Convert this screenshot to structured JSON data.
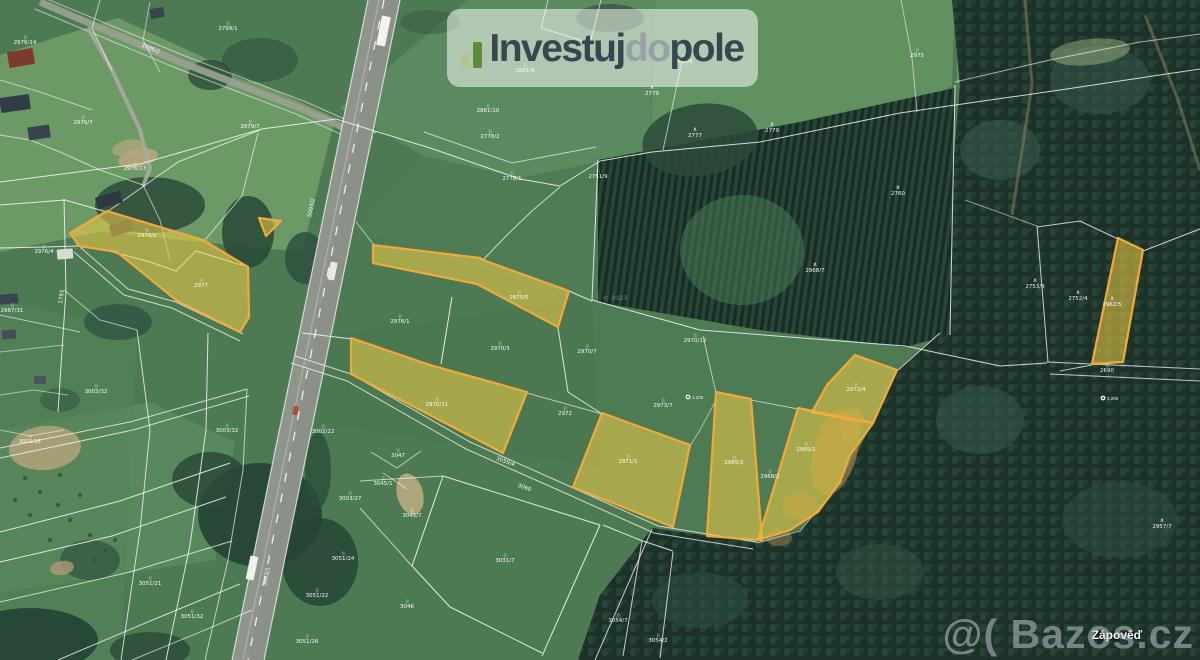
{
  "logo": {
    "invest": "Investuj",
    "do_part": "do",
    "pole": "pole"
  },
  "watermark": {
    "text": "@( Bazos.cz"
  },
  "place_label": {
    "text": "Zápověď"
  },
  "map": {
    "colors": {
      "base": "#4e7a53",
      "forest_base": "#1d332a",
      "plantation_base": "#223d31",
      "highlight_fill": "rgba(240,205,70,0.55)",
      "highlight_stroke": "#f2a93b",
      "road": "#8f948d",
      "boundary_line": "#ffffff"
    },
    "fields": [
      {
        "p": "0,55 118,18 335,118 302,252 100,232 0,252",
        "f": "#6f9b68",
        "o": 0.95
      },
      {
        "p": "340,108 468,0 655,0 650,152 520,178 424,156",
        "f": "#5c8b60",
        "o": 0.95
      },
      {
        "p": "655,0 955,0 952,86 900,112 760,141 651,151",
        "f": "#649263",
        "o": 0.9
      },
      {
        "p": "957,0 1200,0 1200,34 1050,60 957,84",
        "f": "#6f9a67",
        "o": 0.85
      },
      {
        "p": "424,157 520,179 600,162 592,300 356,231",
        "f": "#507d55",
        "o": 0.8
      },
      {
        "p": "302,338 592,300 703,332 790,410 600,468 302,420",
        "f": "#4a7650",
        "o": 0.55
      },
      {
        "p": "592,300 905,346 873,423 840,482 757,543 652,528 600,470",
        "f": "#4f7c54",
        "o": 0.7
      },
      {
        "p": "0,430 150,402 235,442 215,560 0,592",
        "f": "#5f8e62",
        "o": 0.7
      },
      {
        "p": "0,300 137,330 121,660 0,660",
        "f": "#568358",
        "o": 0.5
      },
      {
        "p": "250,445 443,476 360,508 412,566 450,607 542,653 560,660 230,660",
        "f": "#4c7951",
        "o": 0.6
      }
    ],
    "forest": {
      "main": {
        "p": "952,0 1200,0 1200,660 578,660 600,595 652,528 757,543 800,530 840,482 873,423 897,370 940,332 950,200 960,86"
      },
      "plantation": {
        "p": "598,160 800,122 955,88 950,335 905,347 760,330 598,302"
      },
      "blobs": [
        [
          742,
          250,
          62,
          55,
          "#4c7f58",
          0.5,
          0
        ],
        [
          700,
          140,
          58,
          36,
          "#2a4a38",
          0.85,
          -8
        ],
        [
          610,
          18,
          34,
          14,
          "#31523c",
          0.7,
          0
        ],
        [
          150,
          205,
          55,
          28,
          "#2b4b39",
          0.85,
          0
        ],
        [
          248,
          232,
          26,
          36,
          "#2b4b39",
          0.9,
          0
        ],
        [
          305,
          258,
          20,
          26,
          "#2e5040",
          0.85,
          0
        ],
        [
          210,
          75,
          22,
          15,
          "#2a4a38",
          0.8,
          0
        ],
        [
          260,
          60,
          38,
          22,
          "#2e5040",
          0.6,
          0
        ],
        [
          118,
          322,
          34,
          18,
          "#2e5040",
          0.75,
          0
        ],
        [
          260,
          515,
          62,
          52,
          "#244234",
          0.9,
          0
        ],
        [
          210,
          480,
          38,
          28,
          "#2a4a38",
          0.85,
          0
        ],
        [
          320,
          562,
          38,
          44,
          "#274536",
          0.85,
          0
        ],
        [
          318,
          470,
          13,
          38,
          "#2d4d3b",
          0.8,
          0
        ],
        [
          300,
          392,
          9,
          22,
          "#2d4d3b",
          0.7,
          0
        ],
        [
          30,
          640,
          68,
          32,
          "#244234",
          0.9,
          0
        ],
        [
          150,
          650,
          40,
          18,
          "#2a4a38",
          0.8,
          0
        ],
        [
          1000,
          150,
          40,
          30,
          "#3a5f50",
          0.5,
          0
        ],
        [
          1100,
          80,
          50,
          34,
          "#34594a",
          0.5,
          0
        ],
        [
          980,
          420,
          44,
          34,
          "#365c4d",
          0.5,
          0
        ],
        [
          1120,
          520,
          58,
          38,
          "#305447",
          0.45,
          0
        ],
        [
          700,
          600,
          48,
          28,
          "#2e5245",
          0.5,
          0
        ],
        [
          880,
          572,
          44,
          28,
          "#335848",
          0.45,
          0
        ],
        [
          430,
          22,
          30,
          12,
          "#35573f",
          0.5,
          0
        ],
        [
          372,
          60,
          14,
          10,
          "#30523e",
          0.6,
          0
        ],
        [
          90,
          560,
          30,
          20,
          "#2a4a38",
          0.6,
          0
        ],
        [
          60,
          400,
          20,
          12,
          "#2e5040",
          0.5,
          0
        ]
      ]
    },
    "dots": [
      [
        25,
        478
      ],
      [
        40,
        492
      ],
      [
        58,
        505
      ],
      [
        30,
        515
      ],
      [
        70,
        520
      ],
      [
        90,
        535
      ],
      [
        50,
        540
      ],
      [
        105,
        550
      ],
      [
        80,
        495
      ],
      [
        15,
        500
      ],
      [
        95,
        560
      ],
      [
        115,
        540
      ],
      [
        35,
        468
      ],
      [
        60,
        475
      ]
    ],
    "soil": [
      [
        138,
        158,
        20,
        9,
        "#b7a67c",
        0.9,
        -12
      ],
      [
        45,
        448,
        36,
        22,
        "#b3a37a",
        0.85,
        -5
      ],
      [
        410,
        494,
        13,
        21,
        "#b9aa80",
        0.9,
        -15
      ],
      [
        62,
        568,
        12,
        7,
        "#ab9a72",
        0.8,
        -10
      ],
      [
        835,
        452,
        22,
        44,
        "#8c7b4a",
        0.8,
        15
      ],
      [
        800,
        506,
        17,
        13,
        "#8c7b4a",
        0.65,
        0
      ],
      [
        779,
        538,
        13,
        8,
        "#8c7b4a",
        0.6,
        0
      ],
      [
        852,
        424,
        12,
        17,
        "#96854f",
        0.55,
        10
      ],
      [
        1090,
        52,
        40,
        13,
        "#9ab27f",
        0.5,
        -6
      ],
      [
        128,
        148,
        16,
        8,
        "#b7a67c",
        0.7,
        -12
      ]
    ],
    "road": {
      "band": "368,0 400,0 264,660 232,660",
      "band_right": "384,0 400,0 264,660 248,660",
      "center": "384,0 248,660",
      "median": "379,0 243,660",
      "edges": [
        "368,0 232,660",
        "400,0 264,660"
      ],
      "local": "40,2 180,62 300,108 372,140",
      "local_edges": [
        "42,-3 185,56 306,102 376,133",
        "35,9 176,68 296,114 369,147"
      ],
      "driveway": "88,28 112,70 140,130 150,168 143,186",
      "dirt": [
        "1025,0 1032,85 1012,215",
        "1145,15 1178,100 1200,170"
      ]
    },
    "tracks": [
      "80,247 128,289 176,302 243,334",
      "74,252 124,295 172,308 240,341",
      "295,356 351,374 470,442 560,482 658,526 757,542",
      "291,363 347,381 466,449 556,489 654,533 753,549",
      "0,448 130,422 247,389",
      "0,458 133,430 249,396",
      "1047,362 1200,369",
      "1050,374 1200,381"
    ],
    "lines": [
      {
        "p": "0,182 140,164 262,129 336,119"
      },
      {
        "p": "336,119 430,148 520,179 560,186 600,161"
      },
      {
        "p": "600,161 652,152 760,142 900,113 1060,90 1200,69"
      },
      {
        "p": "598,160 592,300"
      },
      {
        "p": "592,300 700,330 905,346"
      },
      {
        "p": "955,85 950,335"
      },
      {
        "p": "955,82 1050,60 1140,42 1200,34",
        "o": 0.6
      },
      {
        "p": "424,132 512,163 596,147",
        "o": 0.65
      },
      {
        "p": "548,0 541,28 590,43 601,0",
        "o": 0.65
      },
      {
        "p": "683,57 663,150",
        "o": 0.6
      },
      {
        "p": "0,205 65,200 107,212"
      },
      {
        "p": "64,199 66,290 58,412",
        "o": 0.8
      },
      {
        "p": "107,212 178,162 260,130",
        "o": 0.7
      },
      {
        "p": "205,240 242,196 258,133",
        "o": 0.6
      },
      {
        "p": "0,248 45,247 79,246",
        "o": 0.8
      },
      {
        "p": "0,315 80,332",
        "o": 0.6
      },
      {
        "p": "302,333 352,339",
        "o": 0.8
      },
      {
        "p": "356,222 374,245",
        "o": 0.6
      },
      {
        "p": "452,297 441,364",
        "o": 0.85
      },
      {
        "p": "483,260 506,236 532,211 560,187",
        "o": 0.7
      },
      {
        "p": "569,291 592,301",
        "o": 0.8
      },
      {
        "p": "558,328 568,392 602,414",
        "o": 0.8
      },
      {
        "p": "527,393 602,414",
        "o": 0.6
      },
      {
        "p": "703,336 716,393",
        "o": 0.6
      },
      {
        "p": "751,400 798,409",
        "o": 0.6
      },
      {
        "p": "897,371 940,333",
        "o": 0.8
      },
      {
        "p": "905,346 1000,366 1047,363",
        "o": 0.8
      },
      {
        "p": "1037,226 1048,362",
        "o": 0.75
      },
      {
        "p": "1118,239 1080,221 1037,227",
        "o": 0.75
      },
      {
        "p": "1143,251 1200,229",
        "o": 0.8
      },
      {
        "p": "1092,365 1060,371",
        "o": 0.7
      },
      {
        "p": "965,200 1037,226",
        "o": 0.5
      },
      {
        "p": "443,476 600,525",
        "o": 0.85
      },
      {
        "p": "443,476 412,566",
        "o": 0.85
      },
      {
        "p": "412,566 450,607",
        "o": 0.85
      },
      {
        "p": "450,607 542,653",
        "o": 0.85
      },
      {
        "p": "600,525 542,656",
        "o": 0.85
      },
      {
        "p": "603,525 640,540 673,551",
        "o": 0.8
      },
      {
        "p": "642,541 623,656",
        "o": 0.75
      },
      {
        "p": "673,552 660,658",
        "o": 0.75
      },
      {
        "p": "360,481 443,476",
        "o": 0.65
      },
      {
        "p": "360,508 412,566",
        "o": 0.65
      },
      {
        "p": "371,452 397,468 421,451",
        "o": 0.6
      },
      {
        "p": "383,473 407,489",
        "o": 0.6
      },
      {
        "p": "0,532 120,501 230,463",
        "o": 0.8
      },
      {
        "p": "0,562 112,536 226,497",
        "o": 0.8
      },
      {
        "p": "0,602 130,572 232,541",
        "o": 0.7
      },
      {
        "p": "58,660 150,621 240,584",
        "o": 0.75
      },
      {
        "p": "132,660 205,630 252,610",
        "o": 0.6
      },
      {
        "p": "137,330 150,430 140,530 121,660",
        "o": 0.75
      },
      {
        "p": "208,333 206,430 190,545 166,660",
        "o": 0.8
      },
      {
        "p": "247,389 243,470 228,560 205,660",
        "o": 0.65
      },
      {
        "p": "64,290 100,320 137,330",
        "o": 0.55
      },
      {
        "p": "0,352 64,345",
        "o": 0.5
      },
      {
        "p": "595,660 652,529",
        "o": 0.75
      },
      {
        "p": "757,543 800,531 840,483",
        "o": 0.6
      },
      {
        "p": "901,0 912,58 917,112",
        "o": 0.55
      },
      {
        "p": "105,250 150,262 176,271 196,251 248,267",
        "o": 0.85
      },
      {
        "p": "0,430 30,436 64,430",
        "o": 0.5
      },
      {
        "p": "100,0 92,28 112,70",
        "o": 0.6
      },
      {
        "p": "150,2 143,40 160,72",
        "o": 0.5
      },
      {
        "p": "0,80 40,92 92,110",
        "o": 0.55
      },
      {
        "p": "0,135 30,140 60,152 100,170 143,185",
        "o": 0.6
      },
      {
        "p": "143,185 160,220 170,260",
        "o": 0.55
      },
      {
        "p": "0,395 34,390 68,395",
        "o": 0.5
      },
      {
        "p": "690,446 700,430 716,400",
        "o": 0.5
      }
    ],
    "houses": [
      [
        8,
        50,
        26,
        16,
        -10,
        "#7d3a2e"
      ],
      [
        0,
        96,
        30,
        15,
        -8,
        "#323c47"
      ],
      [
        28,
        126,
        22,
        13,
        -8,
        "#39434e"
      ],
      [
        96,
        194,
        26,
        12,
        -16,
        "#2e3841"
      ],
      [
        110,
        222,
        22,
        12,
        -16,
        "#333d48"
      ],
      [
        57,
        249,
        16,
        10,
        -5,
        "#d8dad4"
      ],
      [
        0,
        294,
        18,
        10,
        -5,
        "#3a444f"
      ],
      [
        2,
        330,
        14,
        9,
        -5,
        "#434d58"
      ],
      [
        34,
        376,
        12,
        8,
        0,
        "#4a545e"
      ],
      [
        150,
        8,
        14,
        10,
        -10,
        "#3a444e"
      ]
    ],
    "vehicles": [
      [
        379,
        16,
        9,
        30,
        "#f2f2ef"
      ],
      [
        329,
        262,
        7,
        18,
        "#e9e9e4"
      ],
      [
        293,
        406,
        5,
        9,
        "#b84a3a"
      ],
      [
        248,
        556,
        8,
        24,
        "#f0f0ec"
      ]
    ],
    "yellow_parcels": [
      {
        "p": "70,233 107,211 203,240 248,267 249,317 240,332 176,300 117,252 105,250 79,246",
        "t": "2977",
        "lx": 201,
        "ly": 287,
        "s": ""
      },
      {
        "p": "259,218 281,221 266,236",
        "t": "",
        "lx": 0,
        "ly": 0,
        "s": ""
      },
      {
        "p": "373,245 480,258 483,260 569,291 558,327 477,284 373,263",
        "t": "2970/5",
        "lx": 519,
        "ly": 299,
        "s": ""
      },
      {
        "p": "351,338 430,365 527,392 503,453 351,374",
        "t": "2970/11",
        "lx": 437,
        "ly": 406,
        "s": ""
      },
      {
        "p": "602,413 690,445 673,527 573,487",
        "t": "2971/1",
        "lx": 628,
        "ly": 463,
        "s": ""
      },
      {
        "p": "716,392 751,399 762,540 707,536",
        "t": "2969/2",
        "lx": 734,
        "ly": 464,
        "s": ""
      },
      {
        "p": "855,355 897,370 873,423 812,412 827,385",
        "t": "2972/4",
        "lx": 856,
        "ly": 391,
        "s": ""
      },
      {
        "p": "798,408 873,423 850,455 840,482 818,512 790,530 758,540 772,494",
        "t": "2969/1",
        "lx": 806,
        "ly": 451,
        "s": ""
      },
      {
        "p": "1118,238 1143,250 1123,362 1092,364",
        "t": "2962/5",
        "lx": 1112,
        "ly": 306,
        "s": "tree"
      }
    ],
    "labels": [
      [
        25,
        44,
        "2976/14",
        ""
      ],
      [
        228,
        30,
        "2799/1",
        ""
      ],
      [
        83,
        124,
        "2976/7",
        ""
      ],
      [
        250,
        128,
        "2979/7",
        ""
      ],
      [
        135,
        170,
        "2976/13",
        ""
      ],
      [
        44,
        253,
        "2976/4",
        ""
      ],
      [
        12,
        312,
        "2987/31",
        ""
      ],
      [
        96,
        393,
        "3002/32",
        ""
      ],
      [
        30,
        443,
        "3002/31",
        ""
      ],
      [
        227,
        432,
        "3003/32",
        ""
      ],
      [
        323,
        433,
        "3002/22",
        ""
      ],
      [
        350,
        500,
        "3003/27",
        ""
      ],
      [
        343,
        560,
        "3051/24",
        ""
      ],
      [
        317,
        597,
        "3051/22",
        ""
      ],
      [
        307,
        643,
        "3051/26",
        ""
      ],
      [
        192,
        618,
        "3051/32",
        ""
      ],
      [
        150,
        585,
        "3051/21",
        ""
      ],
      [
        398,
        457,
        "3047",
        ""
      ],
      [
        383,
        485,
        "3045/1",
        ""
      ],
      [
        412,
        517,
        "3045/7",
        ""
      ],
      [
        505,
        562,
        "3031/7",
        ""
      ],
      [
        407,
        608,
        "3046",
        ""
      ],
      [
        618,
        622,
        "3054/7",
        ""
      ],
      [
        658,
        642,
        "3054/2",
        ""
      ],
      [
        488,
        112,
        "2861/10",
        ""
      ],
      [
        490,
        138,
        "2778/2",
        ""
      ],
      [
        512,
        180,
        "2778/1",
        ""
      ],
      [
        598,
        178,
        "2751/9",
        ""
      ],
      [
        652,
        95,
        "2779",
        "tree"
      ],
      [
        695,
        137,
        "2777",
        "tree"
      ],
      [
        772,
        132,
        "2779",
        "tree"
      ],
      [
        898,
        195,
        "2760",
        "tree"
      ],
      [
        815,
        272,
        "2968/7",
        "tree"
      ],
      [
        695,
        342,
        "2970/12",
        ""
      ],
      [
        587,
        353,
        "2970/7",
        ""
      ],
      [
        565,
        415,
        "2972",
        ""
      ],
      [
        663,
        407,
        "2973/7",
        ""
      ],
      [
        525,
        72,
        "2801/9",
        ""
      ],
      [
        917,
        57,
        "2975",
        ""
      ],
      [
        683,
        63,
        "2861/8",
        ""
      ],
      [
        1035,
        288,
        "2753/8",
        "tree"
      ],
      [
        1078,
        300,
        "2752/4",
        "tree"
      ],
      [
        1107,
        372,
        "2690",
        ""
      ],
      [
        1162,
        528,
        "2957/7",
        "tree"
      ],
      [
        400,
        323,
        "2976/1",
        ""
      ],
      [
        500,
        350,
        "2970/3",
        ""
      ],
      [
        770,
        478,
        "2968/2",
        ""
      ],
      [
        147,
        237,
        "2970/2",
        ""
      ],
      [
        505,
        463,
        "3059/4",
        "",
        20
      ],
      [
        524,
        489,
        "3060",
        "",
        20
      ],
      [
        313,
        208,
        "5093/2",
        "",
        -79
      ],
      [
        268,
        577,
        "5093/1",
        "",
        -79
      ],
      [
        63,
        297,
        "1793",
        "",
        -82
      ],
      [
        150,
        50,
        "2986/2",
        "",
        22
      ],
      [
        615,
        300,
        "© 2023",
        "faint"
      ]
    ],
    "markers": [
      {
        "x": 688,
        "y": 397,
        "t": "1.206"
      },
      {
        "x": 1103,
        "y": 398,
        "t": "1.205"
      }
    ]
  }
}
